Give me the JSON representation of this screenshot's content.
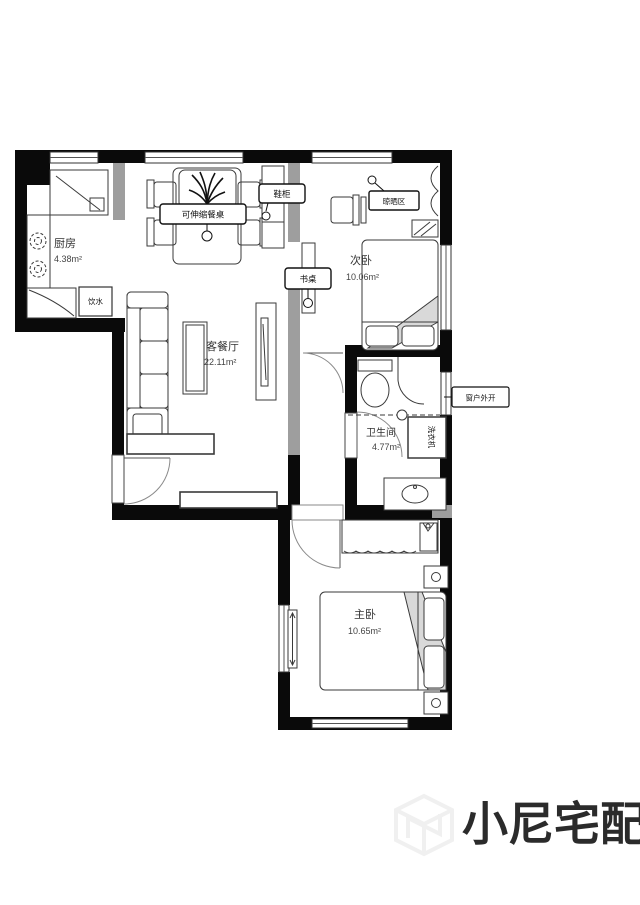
{
  "page": {
    "background": "#ffffff",
    "type": "apartment-floor-plan"
  },
  "colors": {
    "wall": "#0a0a0a",
    "partition_gray": "#9e9e9e",
    "furniture_line": "#3a3a3a",
    "soft_fill": "#d9d9d9",
    "watermark": "#f0f0f0"
  },
  "rooms": [
    {
      "id": "kitchen",
      "name": "厨房",
      "area": "4.38m²"
    },
    {
      "id": "living_dining",
      "name": "客餐厅",
      "area": "22.11m²"
    },
    {
      "id": "second_bedroom",
      "name": "次卧",
      "area": "10.06m²"
    },
    {
      "id": "bathroom",
      "name": "卫生间",
      "area": "4.77m²"
    },
    {
      "id": "master_bedroom",
      "name": "主卧",
      "area": "10.65m²"
    }
  ],
  "annotations": {
    "dining_table": "可伸缩餐桌",
    "shoe_cabinet": "鞋柜",
    "desk": "书桌",
    "drying_area": "晾晒区",
    "window_note": "窗户外开",
    "washing_machine": "洗衣机",
    "water_dispenser": "饮水"
  },
  "watermark": {
    "brand": "小尼宅配",
    "logo": "cube-n-logo"
  }
}
